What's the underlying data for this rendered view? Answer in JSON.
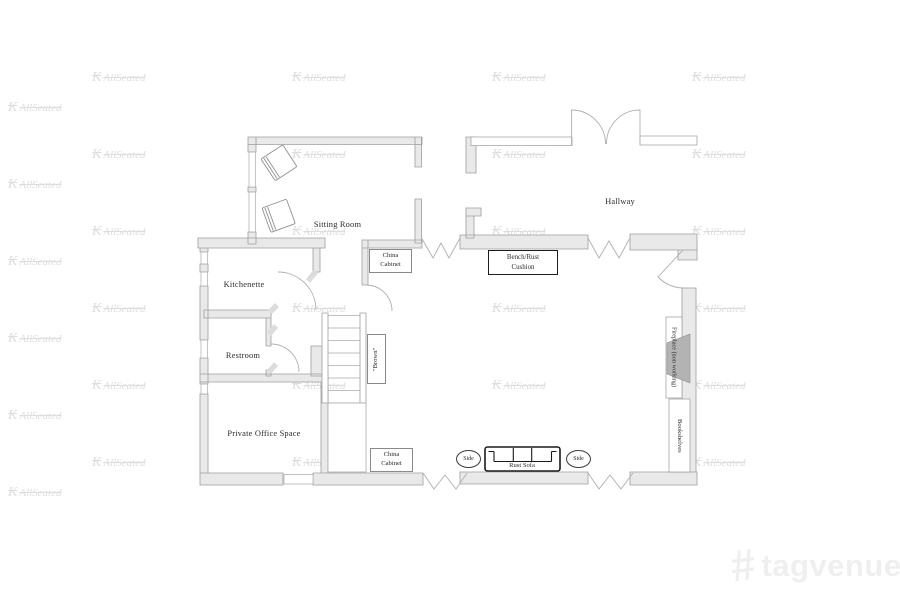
{
  "watermark": {
    "mark": "K",
    "text": "AllSeated"
  },
  "brand": {
    "logo_hash": "#",
    "name": "tagvenue"
  },
  "rooms": {
    "sitting": "Sitting Room",
    "hallway": "Hallway",
    "kitchenette": "Kitchenette",
    "restroom": "Restroom",
    "office": "Private Office Space"
  },
  "labels": {
    "china_top": {
      "line1": "China",
      "line2": "Cabinet"
    },
    "china_bottom": {
      "line1": "China",
      "line2": "Cabinet"
    },
    "bench": {
      "line1": "Bench/Rust",
      "line2": "Cushion"
    },
    "brown": "\"Brown\"",
    "fireplace": "Fireplace (non working)",
    "bookshelves": "Bookshelves",
    "sofa": "Rust Sofa",
    "side_left": "Side",
    "side_right": "Side"
  },
  "colors": {
    "wall_fill": "#e9e9e9",
    "wall_stroke": "#9e9e9e",
    "firebox": "#b3b3b3",
    "furniture_stroke": "#1a1a1a"
  }
}
